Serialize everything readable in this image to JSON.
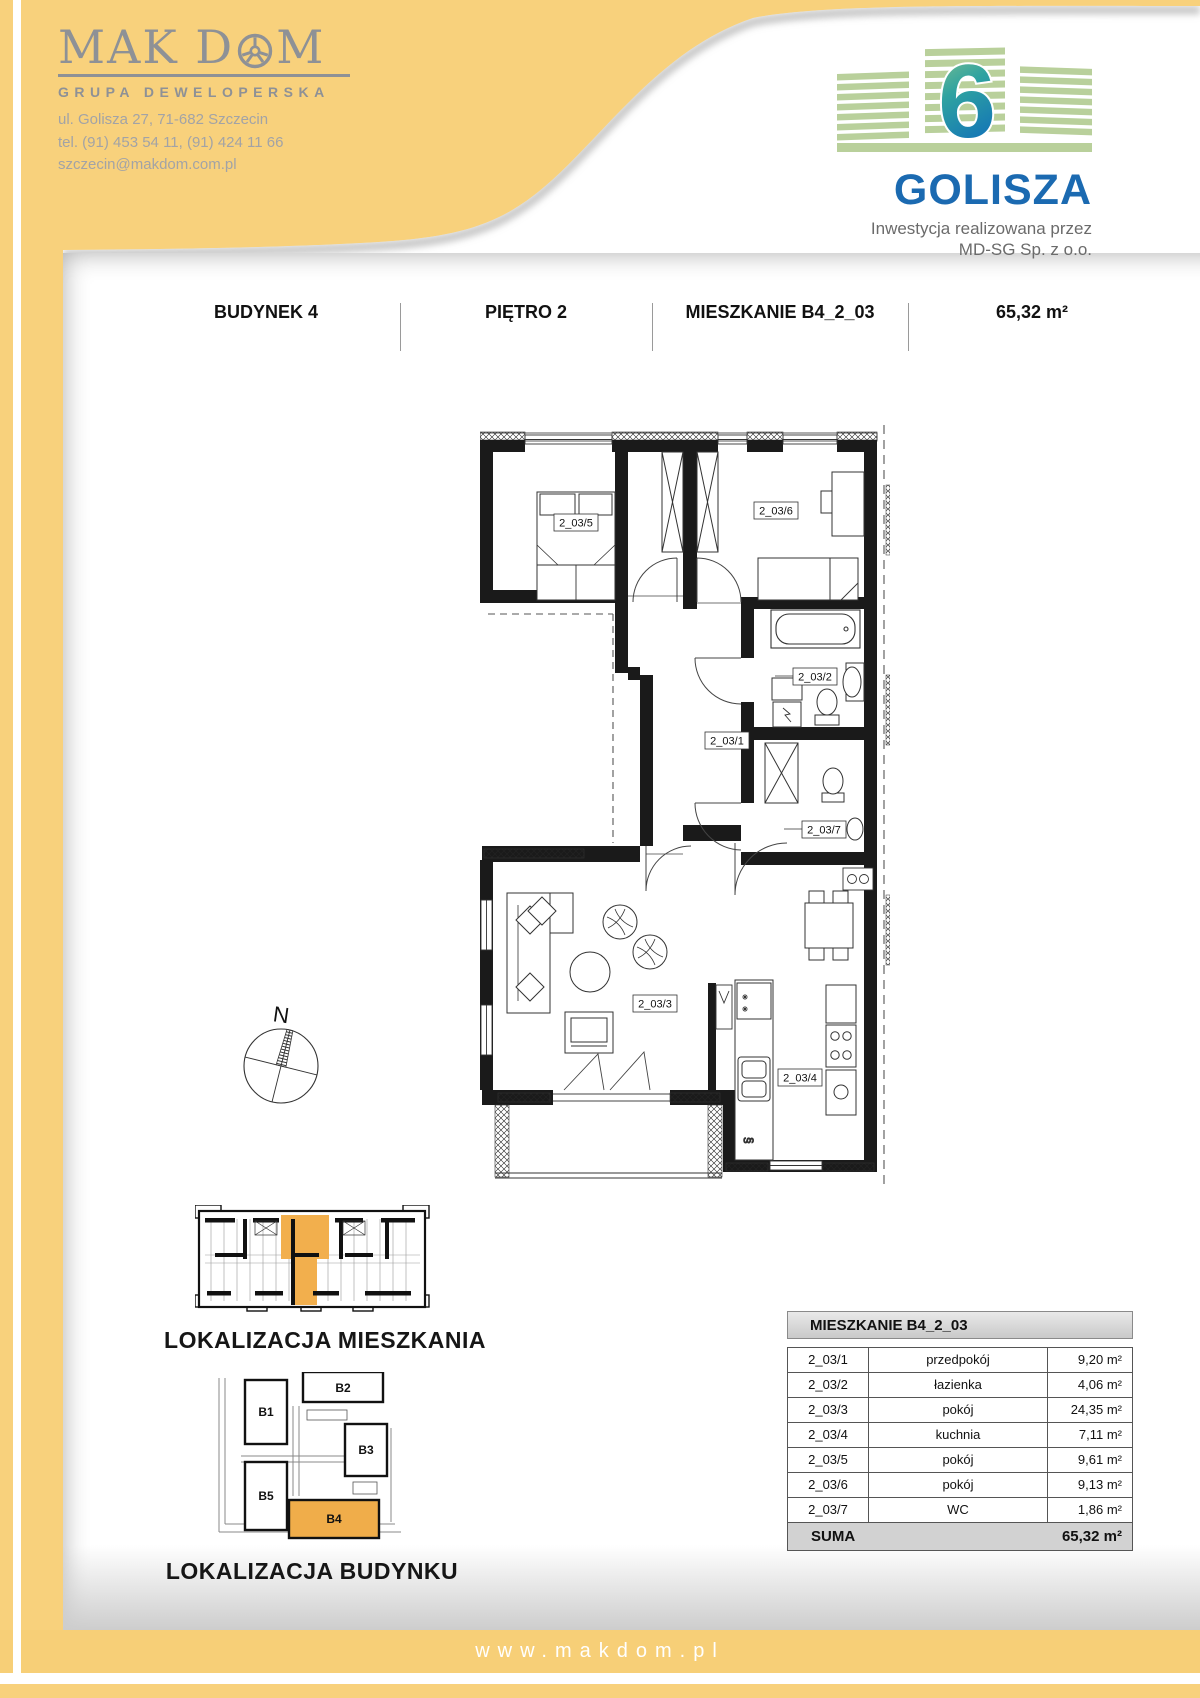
{
  "colors": {
    "accent_yellow": "#F8D17C",
    "footer_yellow": "#F7CF77",
    "highlight_orange": "#F0AE4B",
    "brand_blue": "#1B6AB1",
    "brand_green": "#B9D09B",
    "logo_gray": "#8E9196"
  },
  "company": {
    "name": "MAK DOM",
    "name_part1": "MAK D",
    "name_part2": "M",
    "tagline": "GRUPA DEWELOPERSKA",
    "address": "ul. Golisza 27, 71-682 Szczecin",
    "phone": "tel. (91) 453 54 11, (91) 424 11 66",
    "email": "szczecin@makdom.com.pl"
  },
  "project": {
    "name": "GOLISZA",
    "number": "6",
    "investor_line1": "Inwestycja realizowana przez",
    "investor_line2": "MD-SG Sp. z o.o."
  },
  "header": {
    "building": "BUDYNEK 4",
    "floor": "PIĘTRO 2",
    "apartment": "MIESZKANIE B4_2_03",
    "area": "65,32 m²"
  },
  "plan": {
    "north_label": "N",
    "drain_symbol": "§",
    "rooms": [
      {
        "id": "2_03/1",
        "name": "przedpokój",
        "area": "9,20 m²"
      },
      {
        "id": "2_03/2",
        "name": "łazienka",
        "area": "4,06 m²"
      },
      {
        "id": "2_03/3",
        "name": "pokój",
        "area": "24,35 m²"
      },
      {
        "id": "2_03/4",
        "name": "kuchnia",
        "area": "7,11 m²"
      },
      {
        "id": "2_03/5",
        "name": "pokój",
        "area": "9,61 m²"
      },
      {
        "id": "2_03/6",
        "name": "pokój",
        "area": "9,13 m²"
      },
      {
        "id": "2_03/7",
        "name": "WC",
        "area": "1,86 m²"
      }
    ]
  },
  "locator": {
    "apartment_caption": "LOKALIZACJA MIESZKANIA",
    "building_caption": "LOKALIZACJA BUDYNKU",
    "buildings": [
      "B1",
      "B2",
      "B3",
      "B5",
      "B4"
    ]
  },
  "table": {
    "title": "MIESZKANIE B4_2_03",
    "total_label": "SUMA",
    "total_area": "65,32 m²"
  },
  "footer": {
    "url": "www.makdom.pl"
  }
}
